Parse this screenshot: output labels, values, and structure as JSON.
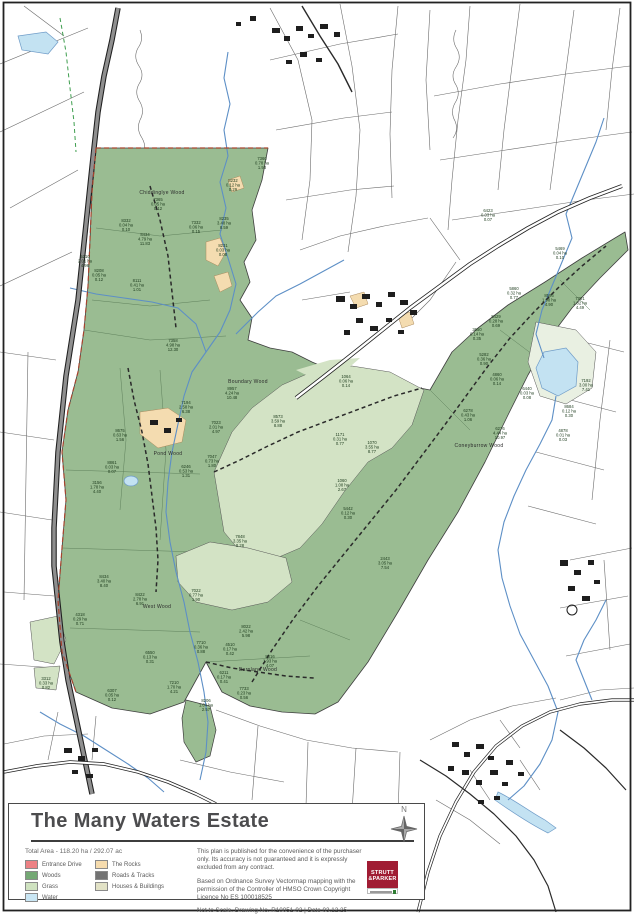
{
  "title_block": {
    "title": "The Many Waters Estate",
    "total_area": "Total Area - 118.20 ha / 292.07 ac",
    "legend": [
      {
        "label": "Entrance Drive",
        "color": "#ec8184"
      },
      {
        "label": "Woods",
        "color": "#74a874"
      },
      {
        "label": "Grass",
        "color": "#cfe2c0"
      },
      {
        "label": "Water",
        "color": "#c9e6f4"
      },
      {
        "label": "The Rocks",
        "color": "#f6dcae"
      },
      {
        "label": "Roads & Tracks",
        "color": "#737373"
      },
      {
        "label": "Houses & Buildings",
        "color": "#e2e2c6"
      }
    ],
    "disclaimer": "This plan is published for the convenience of the purchaser only. Its accuracy is not guaranteed and it is expressly excluded from any contract.",
    "attribution": "Based on Ordnance Survey Vectormap mapping with the permission of the Controller of HMSO   Crown Copyright Licence No ES 100018525",
    "drawing_info": "Not to Scale. Drawing No. R10051-02 | Date 03.12.25",
    "north_label": "N",
    "logo": {
      "line1": "STRUTT",
      "line2": "&PARKER"
    }
  },
  "map": {
    "wood_labels": [
      {
        "text": "Chiddinglye Wood",
        "x": 162,
        "y": 194
      },
      {
        "text": "Boundary Wood",
        "x": 248,
        "y": 383
      },
      {
        "text": "Pond Wood",
        "x": 168,
        "y": 455
      },
      {
        "text": "West Wood",
        "x": 157,
        "y": 608
      },
      {
        "text": "Barnland Wood",
        "x": 258,
        "y": 671
      },
      {
        "text": "Coneyburrow Wood",
        "x": 479,
        "y": 447
      }
    ],
    "parcels": [
      {
        "id": "7360",
        "ha": "0.78 ha",
        "ac": "1.93",
        "x": 262,
        "y": 160
      },
      {
        "id": "8232",
        "ha": "0.12 ha",
        "ac": "0.29",
        "x": 233,
        "y": 182
      },
      {
        "id": "8235",
        "ha": "3.48 ha",
        "ac": "8.59",
        "x": 224,
        "y": 220
      },
      {
        "id": "7365",
        "ha": "0.05 ha",
        "ac": "0.12",
        "x": 158,
        "y": 201
      },
      {
        "id": "8332",
        "ha": "0.04 ha",
        "ac": "0.10",
        "x": 126,
        "y": 222
      },
      {
        "id": "8434",
        "ha": "4.79 ha",
        "ac": "11.83",
        "x": 145,
        "y": 236
      },
      {
        "id": "8231",
        "ha": "0.03 ha",
        "ac": "0.08",
        "x": 223,
        "y": 247
      },
      {
        "id": "7332",
        "ha": "0.06 ha",
        "ac": "0.15",
        "x": 196,
        "y": 224
      },
      {
        "id": "5210",
        "ha": "2.01 ha",
        "ac": "4.96",
        "x": 85,
        "y": 258
      },
      {
        "id": "8208",
        "ha": "0.05 ha",
        "ac": "0.12",
        "x": 99,
        "y": 272
      },
      {
        "id": "8111",
        "ha": "0.41 ha",
        "ac": "1.01",
        "x": 137,
        "y": 282
      },
      {
        "id": "7358",
        "ha": "4.98 ha",
        "ac": "12.30",
        "x": 173,
        "y": 342
      },
      {
        "id": "8957",
        "ha": "4.24 ha",
        "ac": "10.48",
        "x": 232,
        "y": 390
      },
      {
        "id": "7194",
        "ha": "2.58 ha",
        "ac": "6.38",
        "x": 186,
        "y": 404
      },
      {
        "id": "8573",
        "ha": "3.59 ha",
        "ac": "8.88",
        "x": 278,
        "y": 418
      },
      {
        "id": "1064",
        "ha": "0.06 ha",
        "ac": "0.14",
        "x": 346,
        "y": 378
      },
      {
        "id": "1171",
        "ha": "0.31 ha",
        "ac": "0.77",
        "x": 340,
        "y": 436
      },
      {
        "id": "1070",
        "ha": "3.55 ha",
        "ac": "8.77",
        "x": 372,
        "y": 444
      },
      {
        "id": "1060",
        "ha": "1.08 ha",
        "ac": "2.67",
        "x": 342,
        "y": 482
      },
      {
        "id": "7023",
        "ha": "2.01 ha",
        "ac": "4.97",
        "x": 216,
        "y": 424
      },
      {
        "id": "7047",
        "ha": "0.73 ha",
        "ac": "1.80",
        "x": 212,
        "y": 458
      },
      {
        "id": "8675",
        "ha": "0.63 ha",
        "ac": "1.56",
        "x": 120,
        "y": 432
      },
      {
        "id": "8861",
        "ha": "0.03 ha",
        "ac": "0.07",
        "x": 112,
        "y": 464
      },
      {
        "id": "3156",
        "ha": "1.78 ha",
        "ac": "4.40",
        "x": 97,
        "y": 484
      },
      {
        "id": "6246",
        "ha": "0.53 ha",
        "ac": "1.31",
        "x": 186,
        "y": 468
      },
      {
        "id": "7848",
        "ha": "3.35 ha",
        "ac": "8.28",
        "x": 240,
        "y": 538
      },
      {
        "id": "5442",
        "ha": "0.12 ha",
        "ac": "0.30",
        "x": 348,
        "y": 510
      },
      {
        "id": "2443",
        "ha": "3.05 ha",
        "ac": "7.54",
        "x": 385,
        "y": 560
      },
      {
        "id": "8434",
        "ha": "3.40 ha",
        "ac": "8.40",
        "x": 104,
        "y": 578
      },
      {
        "id": "8422",
        "ha": "2.78 ha",
        "ac": "6.91",
        "x": 140,
        "y": 596
      },
      {
        "id": "7022",
        "ha": "0.77 ha",
        "ac": "1.90",
        "x": 196,
        "y": 592
      },
      {
        "id": "4318",
        "ha": "0.29 ha",
        "ac": "0.71",
        "x": 80,
        "y": 616
      },
      {
        "id": "6550",
        "ha": "0.13 ha",
        "ac": "0.31",
        "x": 150,
        "y": 654
      },
      {
        "id": "7710",
        "ha": "0.36 ha",
        "ac": "0.88",
        "x": 201,
        "y": 644
      },
      {
        "id": "4510",
        "ha": "0.17 ha",
        "ac": "0.42",
        "x": 230,
        "y": 646
      },
      {
        "id": "8022",
        "ha": "2.42 ha",
        "ac": "5.98",
        "x": 246,
        "y": 628
      },
      {
        "id": "6211",
        "ha": "0.17 ha",
        "ac": "0.41",
        "x": 224,
        "y": 674
      },
      {
        "id": "8516",
        "ha": "1.93 ha",
        "ac": "4.07",
        "x": 270,
        "y": 658
      },
      {
        "id": "7210",
        "ha": "1.70 ha",
        "ac": "4.21",
        "x": 174,
        "y": 684
      },
      {
        "id": "7733",
        "ha": "0.23 ha",
        "ac": "0.56",
        "x": 244,
        "y": 690
      },
      {
        "id": "3312",
        "ha": "0.33 ha",
        "ac": "0.82",
        "x": 46,
        "y": 680
      },
      {
        "id": "6307",
        "ha": "0.05 ha",
        "ac": "0.12",
        "x": 112,
        "y": 692
      },
      {
        "id": "8206",
        "ha": "1.04 ha",
        "ac": "2.57",
        "x": 206,
        "y": 702
      },
      {
        "id": "5860",
        "ha": "0.32 ha",
        "ac": "0.77",
        "x": 514,
        "y": 290
      },
      {
        "id": "8596",
        "ha": "1.98 ha",
        "ac": "4.90",
        "x": 549,
        "y": 297
      },
      {
        "id": "7301",
        "ha": "1.82 ha",
        "ac": "4.49",
        "x": 580,
        "y": 300
      },
      {
        "id": "5429",
        "ha": "0.28 ha",
        "ac": "0.69",
        "x": 496,
        "y": 318
      },
      {
        "id": "3650",
        "ha": "0.14 ha",
        "ac": "0.35",
        "x": 477,
        "y": 331
      },
      {
        "id": "5282",
        "ha": "0.36 ha",
        "ac": "0.90",
        "x": 484,
        "y": 356
      },
      {
        "id": "4860",
        "ha": "0.06 ha",
        "ac": "0.14",
        "x": 497,
        "y": 376
      },
      {
        "id": "6440",
        "ha": "0.03 ha",
        "ac": "0.08",
        "x": 527,
        "y": 390
      },
      {
        "id": "6278",
        "ha": "0.43 ha",
        "ac": "1.06",
        "x": 468,
        "y": 412
      },
      {
        "id": "6276",
        "ha": "4.44 ha",
        "ac": "10.97",
        "x": 500,
        "y": 430
      },
      {
        "id": "7192",
        "ha": "3.00 ha",
        "ac": "7.41",
        "x": 586,
        "y": 382
      },
      {
        "id": "8684",
        "ha": "0.12 ha",
        "ac": "0.30",
        "x": 569,
        "y": 408
      },
      {
        "id": "4878",
        "ha": "0.01 ha",
        "ac": "0.03",
        "x": 563,
        "y": 432
      },
      {
        "id": "6423",
        "ha": "0.03 ha",
        "ac": "0.07",
        "x": 488,
        "y": 212
      },
      {
        "id": "5469",
        "ha": "0.04 ha",
        "ac": "0.10",
        "x": 560,
        "y": 250
      }
    ]
  }
}
